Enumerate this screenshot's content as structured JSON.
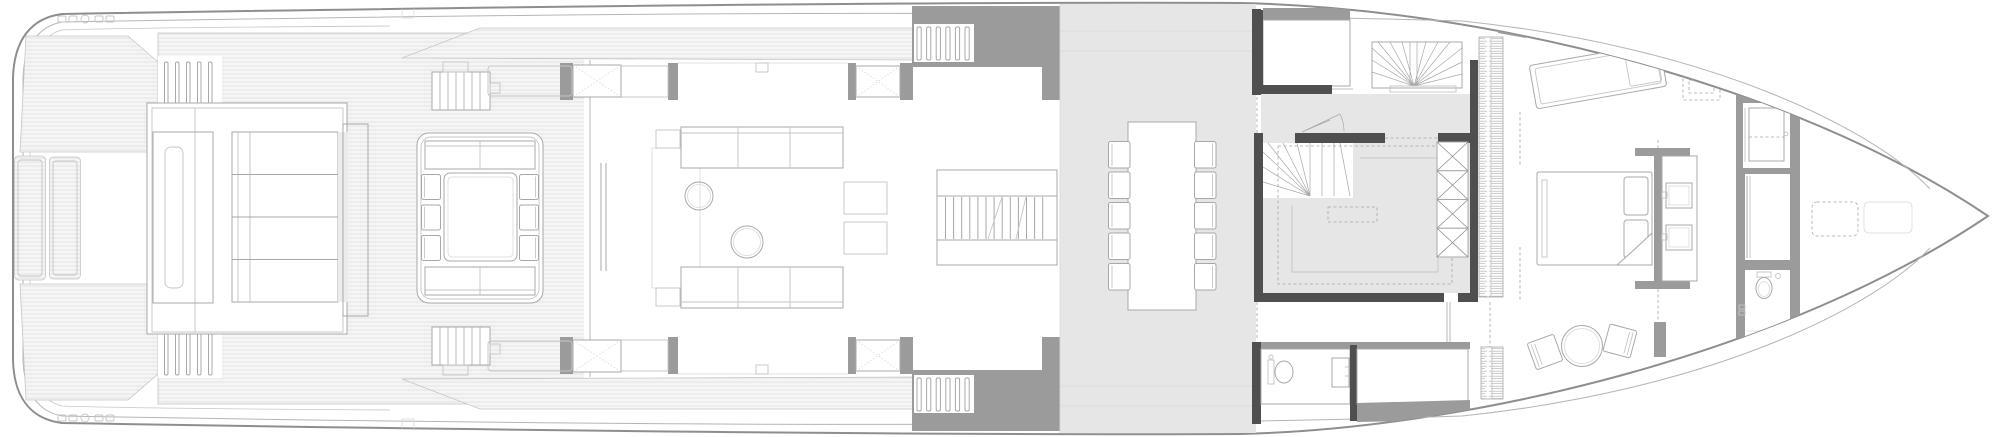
{
  "document": {
    "kind": "yacht-deck-floor-plan",
    "orientation": "bow-right-stern-left"
  },
  "colors": {
    "white": "#ffffff",
    "hull_outline": "#8e8e8e",
    "inner_line": "#b5b5b5",
    "inner_line_2": "#c6c6c6",
    "teak_fill": "#f5f5f5",
    "teak_line": "#dcdcdc",
    "louver_line": "#b2b2b2",
    "wall_gray": "#9b9b9b",
    "wall_dark": "#4f4f4f",
    "floor_gray": "#e6e6e6",
    "furniture_line": "#a8a8a8",
    "furniture_line_light": "#c5c5c5",
    "furniture_line_xlight": "#d9d9d9",
    "dash_line": "#a5a5a5"
  },
  "repeats": {
    "dining_chairs_per_side": 5,
    "aft_table_chairs_per_side": 3,
    "sunpad_cushions": 4,
    "wardrobe_x_cells": 4,
    "stern_stair_slats": 5,
    "side_stair_slats": 6,
    "tv_console_slats": 13,
    "deck_hatch_boxes": 4
  },
  "areas": [
    {
      "name": "stern-swim-platform",
      "features": [
        "teak decking",
        "two lazarette hatches",
        "cleats"
      ]
    },
    {
      "name": "beach-club-sunpad",
      "features": [
        "four-section sunpad",
        "backrest console",
        "side steps"
      ]
    },
    {
      "name": "aft-deck",
      "features": [
        "outdoor dining table",
        "six chairs",
        "perimeter sofa",
        "stairs"
      ]
    },
    {
      "name": "salon",
      "features": [
        "two facing sofas",
        "two round coffee tables",
        "two side tables",
        "slatted tv-console"
      ]
    },
    {
      "name": "dining-area",
      "features": [
        "long table",
        "ten chairs",
        "gray floor"
      ]
    },
    {
      "name": "midship-core",
      "features": [
        "pantry",
        "fan stairs up",
        "fan stairs down",
        "galley outline below",
        "x-front wardrobe",
        "louvered lockers"
      ]
    },
    {
      "name": "day-head",
      "features": [
        "wc",
        "washbasin"
      ]
    },
    {
      "name": "owners-cabin",
      "features": [
        "chaise longue",
        "double bed",
        "headboard partition",
        "twin-sink vanity",
        "round table with two chairs"
      ]
    },
    {
      "name": "owners-bathroom",
      "features": [
        "shower",
        "walk-in closet",
        "wc"
      ]
    },
    {
      "name": "foredeck",
      "features": [
        "two deck boxes"
      ]
    }
  ]
}
